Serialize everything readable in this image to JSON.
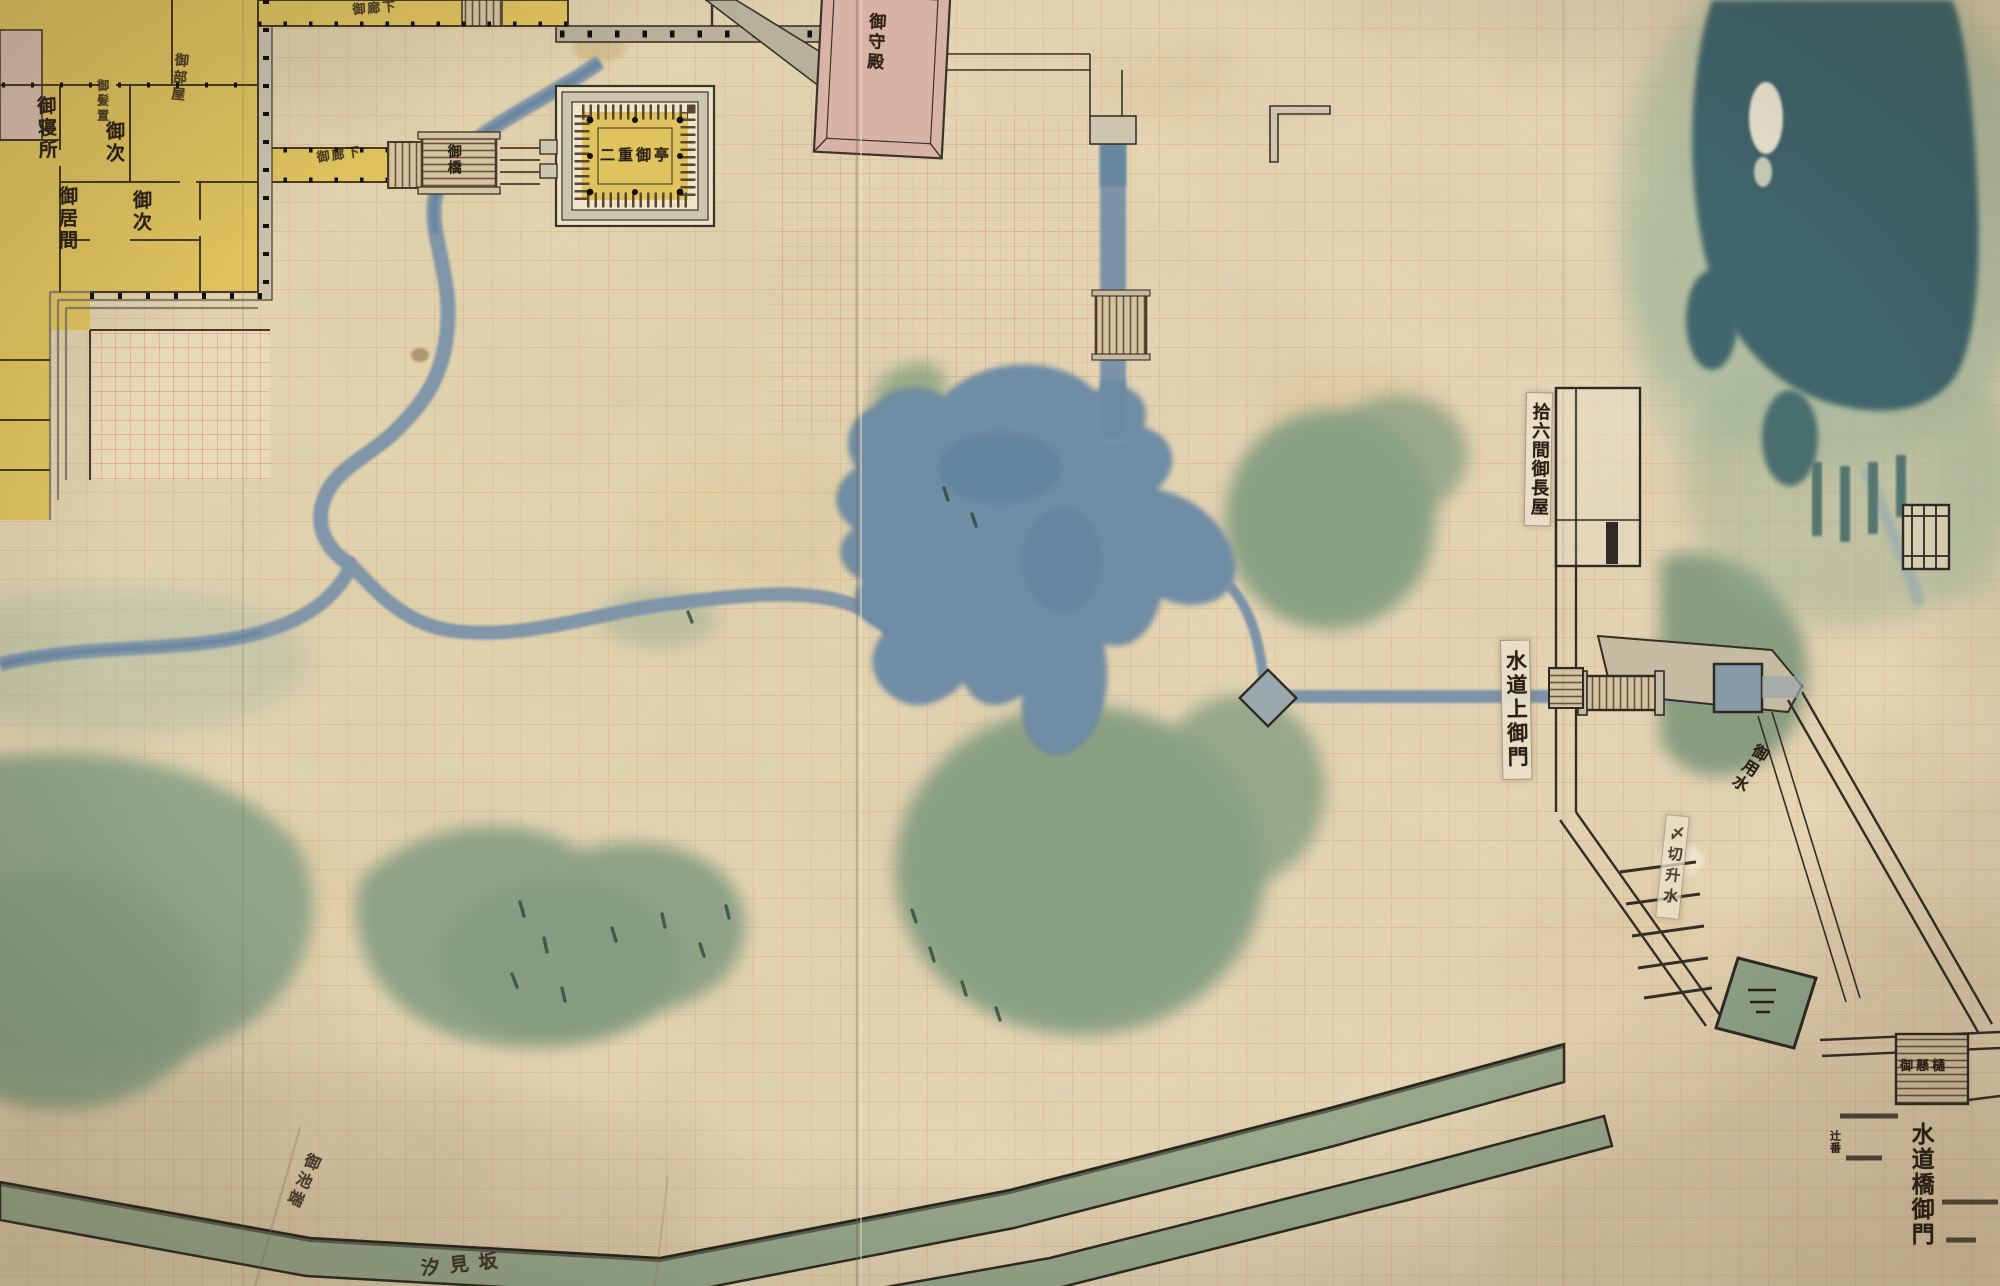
{
  "palette": {
    "paper": "#e5d7b3",
    "grid_orange": "#c4693a",
    "grid_fine_red": "#c75947",
    "water_stream": "#7b93a8",
    "water_dark": "#5d7f9c",
    "moat_pond": "#3f666c",
    "vegetation": "#8fa287",
    "vegetation_dark": "#76917c",
    "building_yellow": "#dfc35f",
    "building_pink": "#d8b2a4",
    "roof_grey": "#b8b09a",
    "ink": "#3a3127"
  },
  "labels": {
    "goshinjo": "御寝所",
    "okamioki": "御髪置",
    "otsugi_a": "御次",
    "oima": "御居間",
    "otsugi_b": "御次",
    "obeya": "御部屋",
    "oroka_a": "御廊下",
    "oroka_b": "御廊下",
    "ohashi": "御橋",
    "otei": "二重御亭",
    "goshuden": "御守殿",
    "nagaya": "拾六間御長屋",
    "suido_kami_gomon": "水道上御門",
    "goyousui": "御用水",
    "masu_slip": "〆切升水",
    "okakehi": "御懸樋",
    "suidobashi_gomon": "水道橋御門",
    "tsujiban": "辻番",
    "oikebata": "御池端",
    "bottom_partial": "汐見坂"
  }
}
